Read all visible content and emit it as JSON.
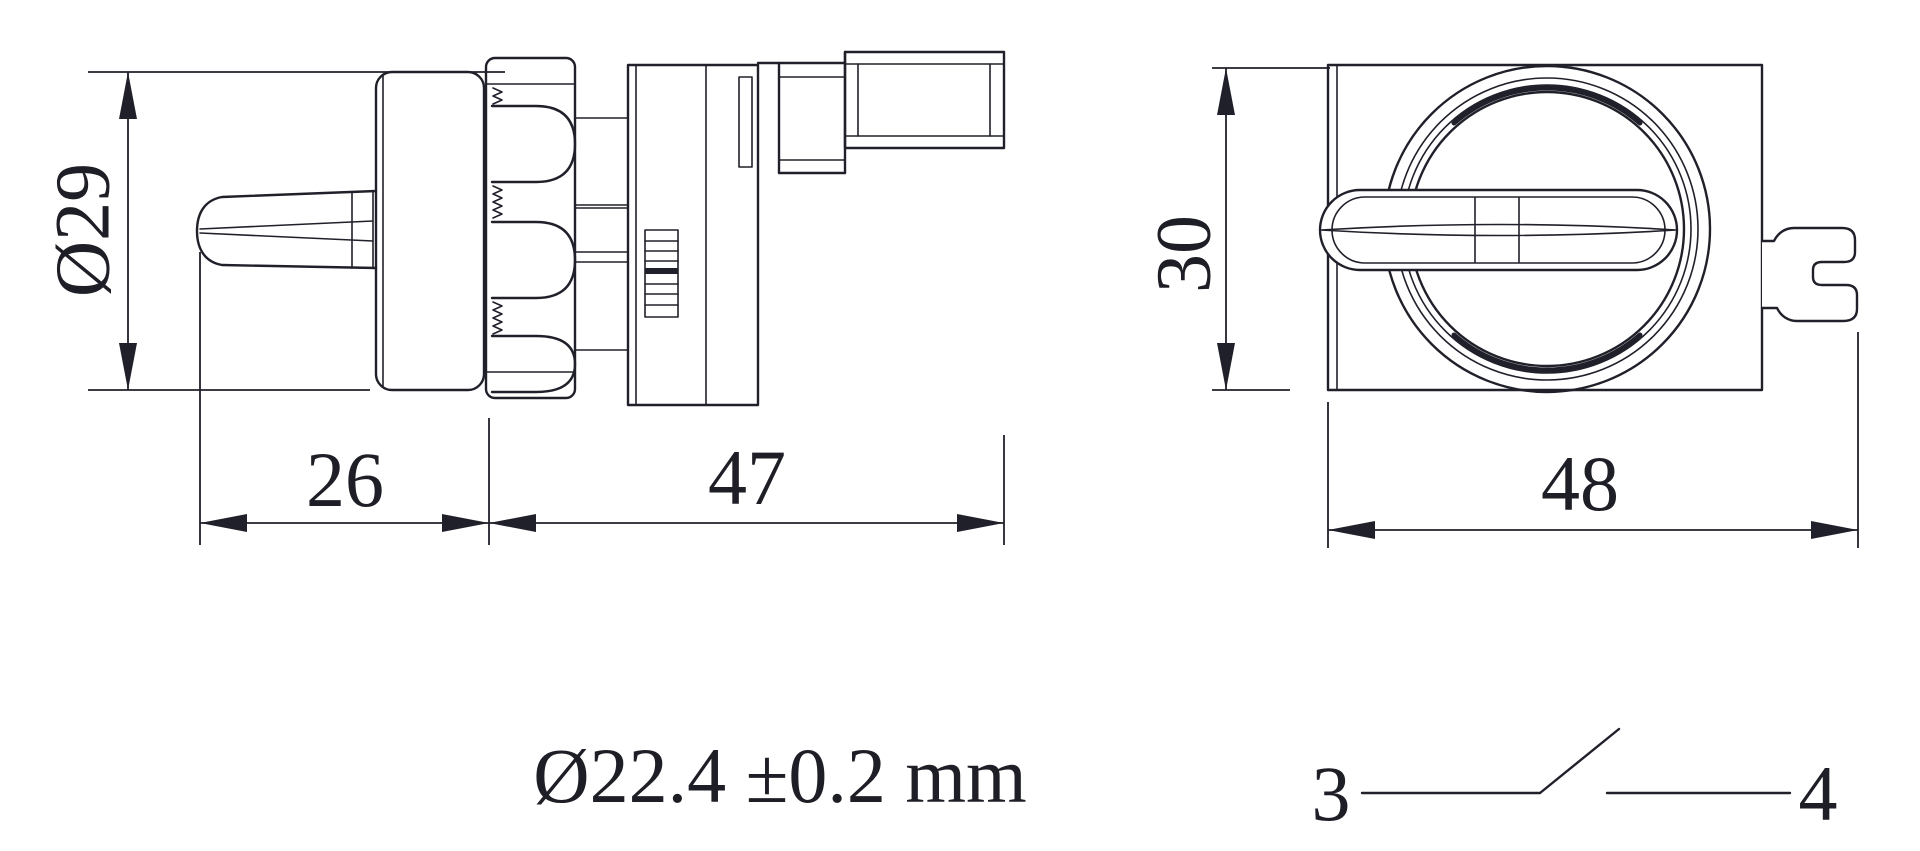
{
  "drawing": {
    "side_view": {
      "diameter_dim": "Ø29",
      "front_length_dim": "26",
      "rear_length_dim": "47"
    },
    "front_view": {
      "height_dim": "30",
      "width_dim": "48"
    },
    "note": "Ø22.4 ±0.2 mm",
    "contact_diagram": {
      "terminal_left": "3",
      "terminal_right": "4"
    }
  },
  "colors": {
    "line": "#20202a",
    "background": "#ffffff"
  }
}
